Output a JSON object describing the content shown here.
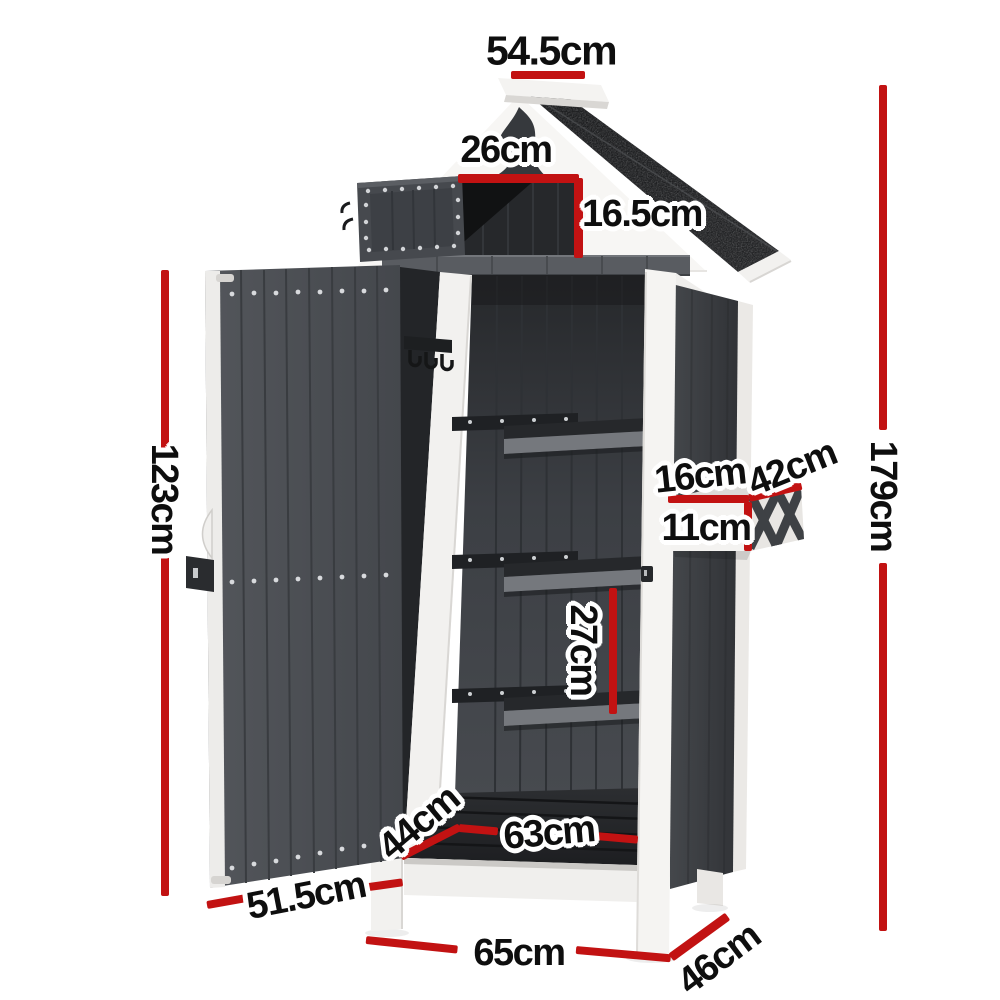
{
  "diagram": {
    "type": "product-dimension-diagram",
    "subject": "outdoor garden storage shed cabinet with peaked roof, open top hatch, open door showing three shelves and hooks, and side planter box",
    "accent_color": "#c21212",
    "colors": {
      "background": "#ffffff",
      "roof": "#1c1d1f",
      "panel_dark": "#45484d",
      "frame_white": "#f4f3f1",
      "label_text": "#0e0e0e"
    },
    "labels": {
      "roof_width": "54.5cm",
      "hatch_width": "26cm",
      "hatch_height": "16.5cm",
      "overall_height": "179cm",
      "door_height": "123cm",
      "planter_depth": "16cm",
      "planter_width": "42cm",
      "planter_height": "11cm",
      "shelf_spacing": "27cm",
      "floor_depth": "44cm",
      "floor_width": "63cm",
      "door_width": "51.5cm",
      "base_width": "65cm",
      "base_depth": "46cm"
    }
  }
}
